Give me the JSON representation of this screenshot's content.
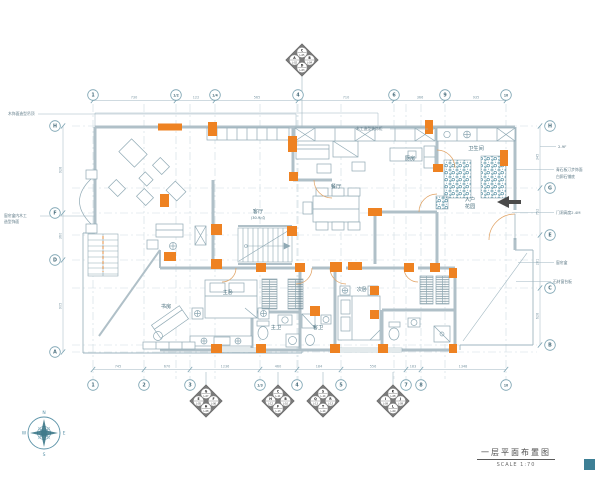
{
  "page": {
    "title": "一层平面布置图",
    "scale": "SCALE 1:70"
  },
  "colors": {
    "accent": "#EE8222",
    "line": "#8FA9B4",
    "wall": "#B0C0C8",
    "hatch": "#47869B",
    "marker_fill": "#7A7A7A",
    "text": "#4A6F7E",
    "dim": "#7D99A6",
    "legend_square": "#3D7F95"
  },
  "grid": {
    "top_axes": [
      {
        "label": "1",
        "x": 93
      },
      {
        "label": "1/2",
        "x": 176
      },
      {
        "label": "1/4",
        "x": 215
      },
      {
        "label": "4",
        "x": 298
      },
      {
        "label": "6",
        "x": 394
      },
      {
        "label": "9",
        "x": 445
      },
      {
        "label": "10",
        "x": 506
      }
    ],
    "bottom_axes": [
      {
        "label": "1",
        "x": 93
      },
      {
        "label": "2",
        "x": 144
      },
      {
        "label": "3",
        "x": 190
      },
      {
        "label": "1/3",
        "x": 260
      },
      {
        "label": "4",
        "x": 297
      },
      {
        "label": "5",
        "x": 341
      },
      {
        "label": "7",
        "x": 406
      },
      {
        "label": "8",
        "x": 421
      },
      {
        "label": "10",
        "x": 506
      }
    ],
    "left_axes": [
      {
        "label": "H",
        "y": 126
      },
      {
        "label": "F",
        "y": 213
      },
      {
        "label": "D",
        "y": 260
      },
      {
        "label": "A",
        "y": 352
      }
    ],
    "right_axes": [
      {
        "label": "H",
        "y": 126
      },
      {
        "label": "G",
        "y": 188
      },
      {
        "label": "E",
        "y": 235
      },
      {
        "label": "C",
        "y": 288
      },
      {
        "label": "B",
        "y": 345
      }
    ]
  },
  "dimensions": {
    "top": [
      {
        "v": "730",
        "x": 134
      },
      {
        "v": "122",
        "x": 196
      },
      {
        "v": "565",
        "x": 257
      },
      {
        "v": "710",
        "x": 346
      },
      {
        "v": "366",
        "x": 420
      },
      {
        "v": "935",
        "x": 476
      }
    ],
    "bottom": [
      {
        "v": "745",
        "x": 118
      },
      {
        "v": "670",
        "x": 167
      },
      {
        "v": "1236",
        "x": 225
      },
      {
        "v": "460",
        "x": 278
      },
      {
        "v": "184",
        "x": 319
      },
      {
        "v": "556",
        "x": 373
      },
      {
        "v": "183",
        "x": 413
      },
      {
        "v": "1348",
        "x": 463
      }
    ],
    "left": [
      {
        "v": "928",
        "y": 170
      },
      {
        "v": "360",
        "y": 236
      },
      {
        "v": "905",
        "y": 306
      }
    ],
    "right": [
      {
        "v": "345",
        "y": 157
      },
      {
        "v": "752",
        "y": 212
      },
      {
        "v": "281",
        "y": 262
      },
      {
        "v": "628",
        "y": 316
      }
    ]
  },
  "rooms": [
    {
      "name": "客厅",
      "sub": "(30.9㎡)"
    },
    {
      "name": "餐厅",
      "sub": ""
    },
    {
      "name": "厨房",
      "sub": ""
    },
    {
      "name": "卫生间",
      "sub": ""
    },
    {
      "name": "入户",
      "sub": "花园"
    },
    {
      "name": "主卧",
      "sub": ""
    },
    {
      "name": "次卧",
      "sub": ""
    },
    {
      "name": "书房",
      "sub": ""
    },
    {
      "name": "主卫",
      "sub": ""
    },
    {
      "name": "客卫",
      "sub": ""
    }
  ],
  "annotations": [
    "木饰面造型吊顶",
    "窗帘盒内木工",
    "造型饰面",
    "木工造型装饰柜",
    "2-9F",
    "青石板汀步饰面",
    "白卵石铺底",
    "门洞高度2.4M",
    "窗帘盒",
    "石材窗台板"
  ],
  "elevation_markers": [
    {
      "x": 302,
      "y": 60,
      "leader_to_y": 127,
      "top": {
        "letter": "C",
        "code": "L-05"
      },
      "left": {
        "letter": "A",
        "code": "L-02"
      },
      "right": {
        "letter": "B",
        "code": "L-04"
      },
      "bottom": {
        "letter": "D",
        "code": "L-03"
      }
    },
    {
      "x": 206,
      "y": 401,
      "leader_to_y": 372,
      "top": {
        "letter": "G",
        "code": "L-07"
      },
      "left": {
        "letter": "E",
        "code": "L-05"
      },
      "right": {
        "letter": "F",
        "code": "L-06"
      },
      "bottom": {
        "letter": "H",
        "code": "L-08"
      }
    },
    {
      "x": 278,
      "y": 401,
      "leader_to_y": 372,
      "top": {
        "letter": "C",
        "code": "L-11"
      },
      "left": {
        "letter": "H",
        "code": "L-12"
      },
      "right": {
        "letter": "B",
        "code": "L-10"
      },
      "bottom": {
        "letter": "F",
        "code": "L-13"
      }
    },
    {
      "x": 323,
      "y": 401,
      "leader_to_y": 372,
      "top": {
        "letter": "S",
        "code": "L-14"
      },
      "left": {
        "letter": "Q",
        "code": "L-13"
      },
      "right": {
        "letter": "R",
        "code": "L-13"
      },
      "bottom": {
        "letter": "T",
        "code": "L-14"
      }
    },
    {
      "x": 393,
      "y": 401,
      "leader_to_y": 372,
      "top": {
        "letter": "K",
        "code": "L-08"
      },
      "left": {
        "letter": "I",
        "code": "L-09"
      },
      "right": {
        "letter": "J",
        "code": "L-09"
      },
      "bottom": {
        "letter": "L",
        "code": "L-09"
      }
    }
  ],
  "compass": {
    "labels": {
      "n": "N",
      "e": "E",
      "s": "S",
      "w": "W"
    }
  }
}
